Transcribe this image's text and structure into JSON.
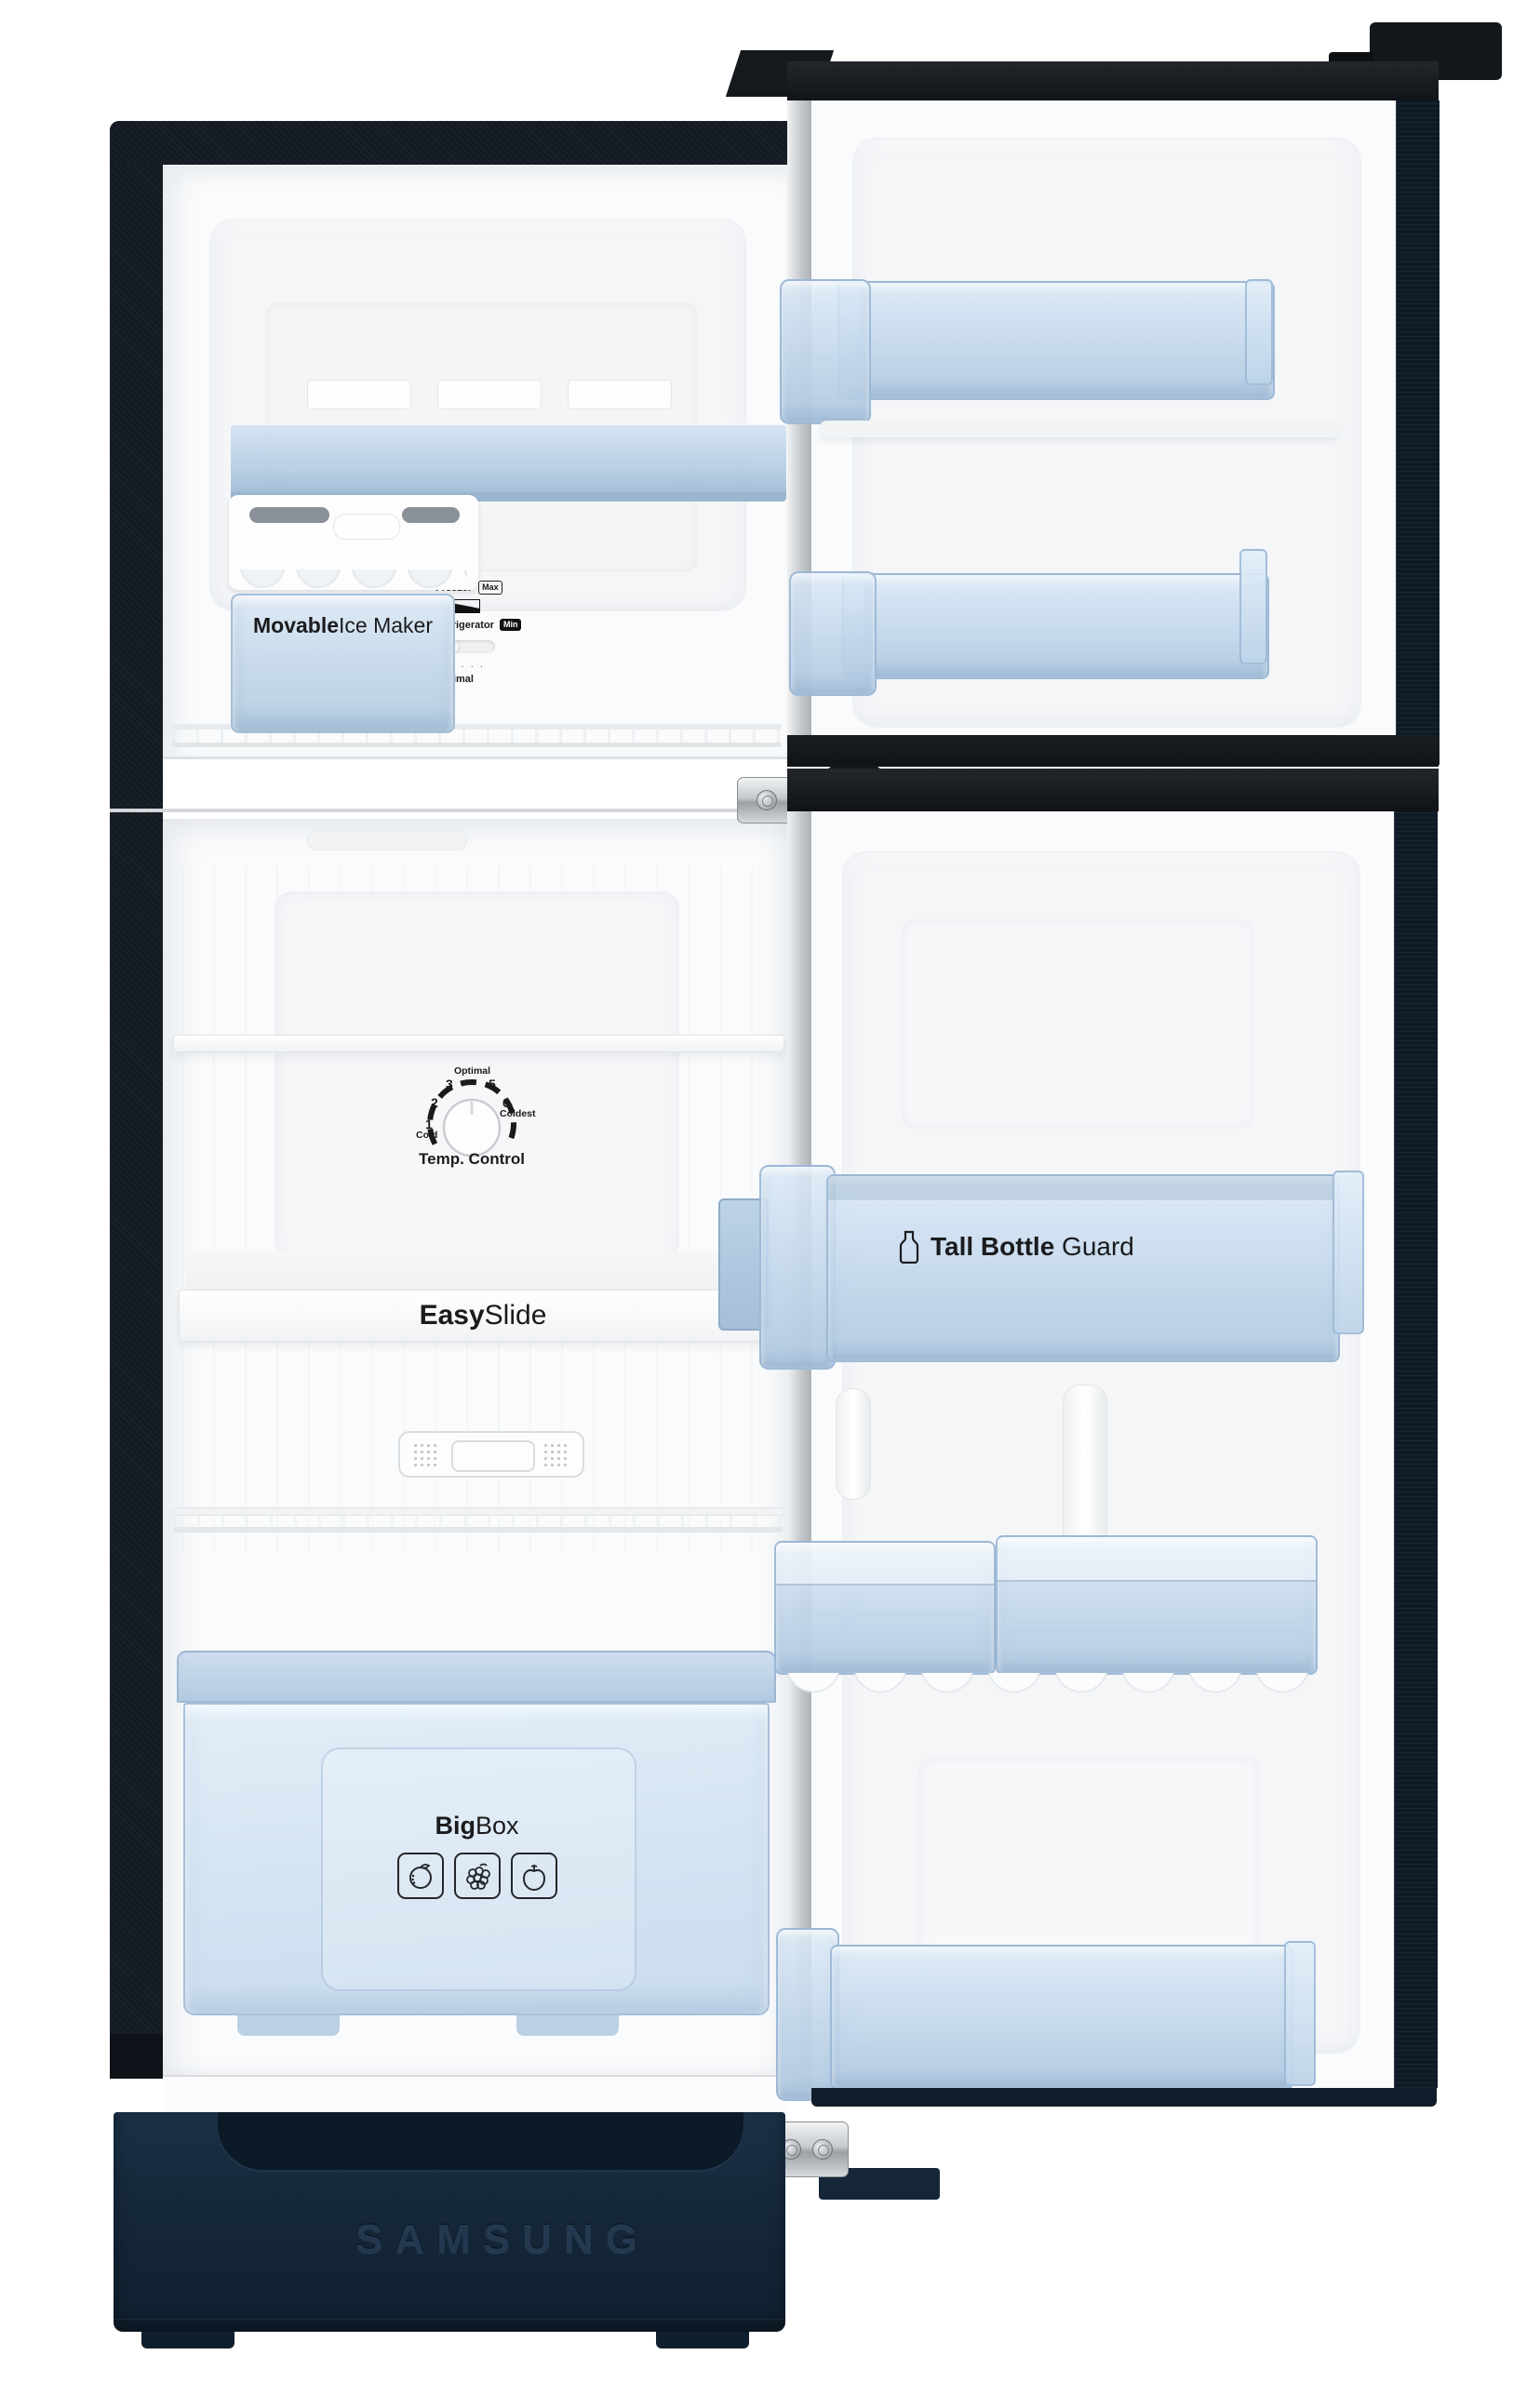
{
  "product": {
    "brand_logo": "SAMSUNG",
    "type": "top-mount double door refrigerator, doors open"
  },
  "freezer": {
    "ice_maker": {
      "label_bold": "Movable",
      "label_rest": " Ice Maker"
    },
    "control_panel": {
      "freezer_label": "Freezer",
      "max_badge": "Max",
      "refrigerator_label": "Refrigerator",
      "min_badge": "Min",
      "marker": "▲",
      "dots": "····",
      "optimal_label": "Optimal"
    }
  },
  "fridge": {
    "temp_dial": {
      "label": "Temp. Control",
      "ticks": [
        {
          "num": "1",
          "sub": "Cold"
        },
        {
          "num": "2",
          "sub": ""
        },
        {
          "num": "3",
          "sub": ""
        },
        {
          "num": "",
          "sub": "Optimal"
        },
        {
          "num": "5",
          "sub": ""
        },
        {
          "num": "6",
          "sub": "Coldest"
        }
      ]
    },
    "easy_slide": {
      "label_bold": "Easy",
      "label_rest": " Slide"
    },
    "big_box": {
      "label_bold": "Big",
      "label_rest": " Box",
      "icons": [
        "orange-icon",
        "grapes-icon",
        "apple-icon"
      ]
    }
  },
  "door": {
    "tall_bottle_guard": {
      "label_bold": "Tall Bottle",
      "label_rest": " Guard"
    }
  },
  "colors": {
    "base_navy": "#16293c",
    "frame_black": "#141a21",
    "door_edge_navy": "#0e1a26",
    "bin_blue": "#c9dcec",
    "liner_white": "#fafbfc"
  }
}
